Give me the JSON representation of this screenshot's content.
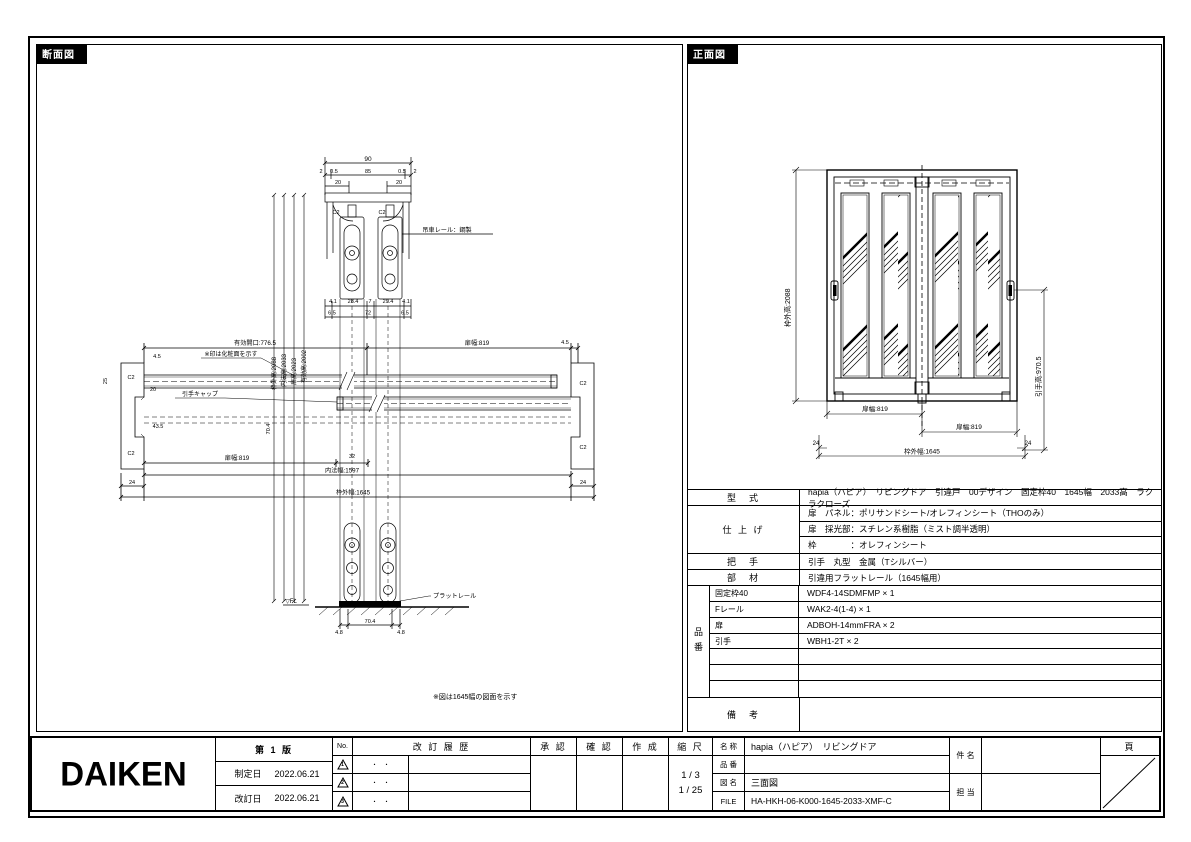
{
  "page": {
    "bg": "#ffffff",
    "ink": "#000000"
  },
  "section_panel": {
    "title": "断面図"
  },
  "front_panel": {
    "title": "正面図"
  },
  "sec": {
    "n90": "90",
    "n2": "2",
    "n05": "0.5",
    "n85": "85",
    "n20": "20",
    "c2": "C2",
    "rail": "吊車レール：鋼製",
    "n41": "4.1",
    "n284": "28.4",
    "n7": "7",
    "n294": "29.4",
    "n65": "6.5",
    "n72": "72",
    "vouter": "枠外高:2088",
    "vinner": "内法高:2033",
    "vdoor": "扉高:2023",
    "veff": "有効高:2002",
    "open": "有効開口:776.5",
    "facenote": "※印は化粧面を示す",
    "capnote": "引手キャップ",
    "n45": "4.5",
    "n25": "25",
    "n435": "43.5",
    "n704": "70.4",
    "n32": "32",
    "doorw": "扉幅:819",
    "innerw": "内法幅:1597",
    "outerw": "枠外幅:1645",
    "n24": "24",
    "fl": "▽FL",
    "flatrail": "プラットレール",
    "n48": "4.8",
    "note": "※図は1645幅の図面を示す"
  },
  "front": {
    "vouter": "枠外高:2088",
    "vhandle": "引手高:970.5",
    "doorw": "扉幅:819",
    "n24": "24",
    "outerw": "枠外幅:1645"
  },
  "spec": {
    "model_label": "型　式",
    "model": "hapia（ハピア）　リビングドア　引違戸　00デザイン　固定枠40　1645幅　2033高　ラクラクローズ",
    "finish_label": "仕 上 げ",
    "finish_rows": [
      "扉　パネル：ポリサンドシート/オレフィンシート（THOのみ）",
      "扉　採光部：スチレン系樹脂（ミスト調半透明）",
      "枠　　　　：オレフィンシート"
    ],
    "handle_label": "把　手",
    "handle": "引手　丸型　金属（Tシルバー）",
    "member_label": "部　材",
    "member": "引違用フラットレール（1645幅用）",
    "pn_label": "品番",
    "pn_rows": [
      {
        "name": "固定枠40",
        "value": "WDF4-14SDMFMP × 1"
      },
      {
        "name": "Fレール",
        "value": "WAK2-4(1-4) × 1"
      },
      {
        "name": "扉",
        "value": "ADBOH-14mmFRA × 2"
      },
      {
        "name": "引手",
        "value": "WBH1-2T × 2"
      },
      {
        "name": "",
        "value": ""
      },
      {
        "name": "",
        "value": ""
      },
      {
        "name": "",
        "value": ""
      }
    ],
    "notes_label": "備　考",
    "notes": ""
  },
  "titleblock": {
    "logo": "DAIKEN",
    "edition": "第 1 版",
    "enacted_label": "制定日",
    "enacted": "2022.06.21",
    "revised_label": "改訂日",
    "revised": "2022.06.21",
    "no_label": "No.",
    "rev_marks": [
      "1",
      "2",
      "3"
    ],
    "rev_history_label": "改 訂 履 歴",
    "rev_dots": "・　・",
    "approve_label": "承 認",
    "check_label": "確 認",
    "create_label": "作 成",
    "scale_label": "縮 尺",
    "scale_a": "1 / 3",
    "scale_b": "1 / 25",
    "name_label": "名 称",
    "name": "hapia（ハピア）　リビングドア",
    "pn_label": "品 番",
    "pn": "",
    "dwg_label": "図 名",
    "dwg": "三面図",
    "file_label": "FILE",
    "file": "HA-HKH-06-K000-1645-2033-XMF-C",
    "subject_label": "件 名",
    "staff_label": "担 当",
    "page_label": "頁"
  }
}
